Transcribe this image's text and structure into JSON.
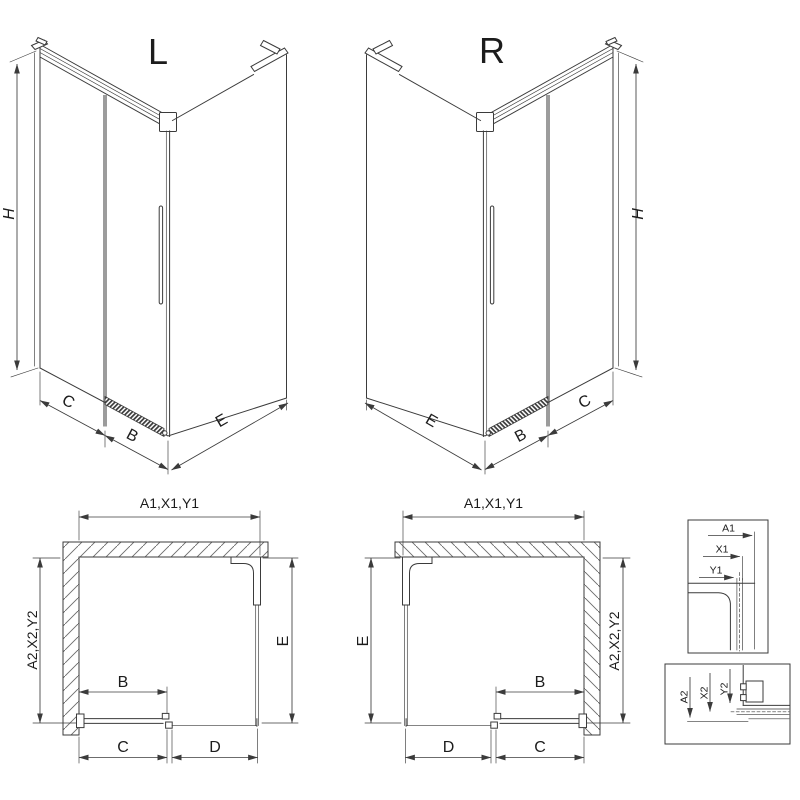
{
  "colors": {
    "line": "#3b3b3b",
    "door_gray": "#9c9c9c",
    "background": "#ffffff"
  },
  "drawing": {
    "iso_left": {
      "title": "L",
      "dim_height": "H",
      "dim_fixed": "C",
      "dim_door": "B",
      "dim_side": "E"
    },
    "iso_right": {
      "title": "R",
      "dim_height": "H",
      "dim_fixed": "C",
      "dim_door": "B",
      "dim_side": "E"
    },
    "plan_left": {
      "dim_top": "A1,X1,Y1",
      "dim_side_wall": "A2,X2,Y2",
      "dim_side_panel": "E",
      "dim_door": "B",
      "dim_door_bottom": "C",
      "dim_fixed_bottom": "D"
    },
    "plan_right": {
      "dim_top": "A1,X1,Y1",
      "dim_side_wall": "A2,X2,Y2",
      "dim_side_panel": "E",
      "dim_door": "B",
      "dim_door_bottom": "C",
      "dim_fixed_bottom": "D"
    },
    "detail_top": {
      "dim_a1": "A1",
      "dim_x1": "X1",
      "dim_y1": "Y1"
    },
    "detail_bottom": {
      "dim_a2": "A2",
      "dim_x2": "X2",
      "dim_y2": "Y2"
    }
  }
}
